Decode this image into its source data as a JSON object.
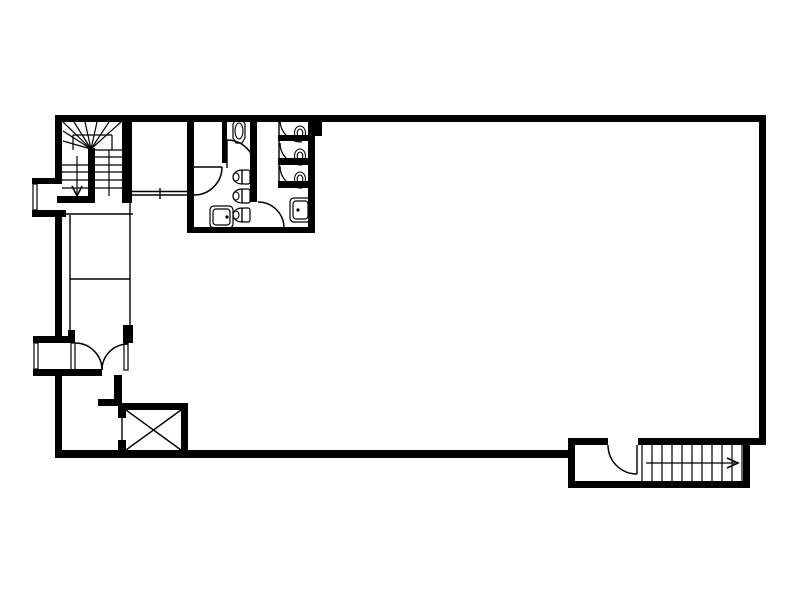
{
  "meta": {
    "description": "architectural-floor-plan",
    "background_color": "#ffffff",
    "line_color": "#000000"
  },
  "canvas": {
    "width": 800,
    "height": 600
  },
  "floorplan": {
    "layers": [
      {
        "name": "wall-segments",
        "item_name": "wall-segment",
        "type": "wall",
        "items": [
          [
            55,
            115,
            711,
            7
          ],
          [
            55,
            115,
            7,
            65
          ],
          [
            55,
            216,
            7,
            121
          ],
          [
            55,
            375,
            7,
            83
          ],
          [
            759,
            115,
            7,
            330
          ],
          [
            55,
            450,
            513,
            8
          ],
          [
            32,
            178,
            30,
            6
          ],
          [
            32,
            210,
            34,
            7
          ],
          [
            33,
            336,
            42,
            7
          ],
          [
            68,
            330,
            7,
            7
          ],
          [
            33,
            369,
            69,
            7
          ],
          [
            122,
            115,
            10,
            88
          ],
          [
            57,
            196,
            38,
            7
          ],
          [
            88,
            148,
            7,
            55
          ],
          [
            123,
            325,
            10,
            18
          ],
          [
            114,
            375,
            8,
            26
          ],
          [
            98,
            399,
            24,
            7
          ],
          [
            118,
            403,
            70,
            7
          ],
          [
            181,
            403,
            7,
            47
          ],
          [
            118,
            403,
            8,
            15
          ],
          [
            118,
            440,
            8,
            12
          ],
          [
            187,
            115,
            7,
            118
          ],
          [
            250,
            115,
            7,
            87
          ],
          [
            308,
            115,
            7,
            118
          ],
          [
            315,
            115,
            7,
            21
          ],
          [
            187,
            227,
            128,
            6
          ],
          [
            222,
            115,
            5,
            48
          ],
          [
            278,
            135,
            37,
            6
          ],
          [
            278,
            158,
            37,
            7
          ],
          [
            278,
            181,
            37,
            7
          ],
          [
            568,
            438,
            40,
            7
          ],
          [
            638,
            438,
            128,
            7
          ],
          [
            568,
            438,
            7,
            50
          ],
          [
            568,
            481,
            182,
            7
          ],
          [
            743,
            438,
            7,
            50
          ]
        ],
        "sw": 0
      },
      {
        "name": "partition-thin-lines",
        "item_name": "thin-wall-line",
        "type": "line",
        "items": [
          [
            62,
            214,
            133,
            214
          ],
          [
            70,
            215,
            70,
            336
          ],
          [
            130,
            203,
            130,
            325
          ],
          [
            70,
            279,
            130,
            279
          ],
          [
            132,
            191.5,
            191,
            191.5
          ],
          [
            132,
            195,
            191,
            195
          ],
          [
            160,
            188,
            160,
            199
          ],
          [
            194,
            167,
            222,
            167
          ],
          [
            227,
            140,
            227,
            168
          ],
          [
            279,
            122,
            279,
            188
          ],
          [
            637,
            445,
            637,
            474
          ]
        ],
        "sw": 1.4
      },
      {
        "name": "upper-stair-treads",
        "item_name": "stair-tread-line",
        "type": "line",
        "items": [
          [
            62,
            165,
            88,
            165
          ],
          [
            62,
            172,
            88,
            172
          ],
          [
            62,
            180,
            88,
            180
          ],
          [
            62,
            188,
            88,
            188
          ],
          [
            95,
            150,
            122,
            150
          ],
          [
            95,
            157,
            122,
            157
          ],
          [
            95,
            165,
            122,
            165
          ],
          [
            95,
            172,
            122,
            172
          ],
          [
            95,
            180,
            122,
            180
          ],
          [
            95,
            188,
            122,
            188
          ],
          [
            109,
            150,
            109,
            196
          ],
          [
            91,
            149,
            63,
            122
          ],
          [
            91,
            149,
            74,
            122
          ],
          [
            91,
            149,
            85,
            122
          ],
          [
            91,
            149,
            97,
            122
          ],
          [
            91,
            149,
            109,
            122
          ],
          [
            91,
            149,
            121,
            122
          ],
          [
            91,
            149,
            63,
            131
          ],
          [
            91,
            149,
            63,
            141
          ],
          [
            73,
            135,
            112,
            135
          ],
          [
            73,
            135,
            73,
            150
          ],
          [
            112,
            135,
            112,
            150
          ],
          [
            77,
            156,
            77,
            194
          ]
        ],
        "sw": 1.2
      },
      {
        "name": "lower-stair-treads",
        "item_name": "stair-tread-line",
        "type": "line",
        "items": [
          [
            642,
            445,
            642,
            481
          ],
          [
            652,
            445,
            652,
            481
          ],
          [
            662,
            445,
            662,
            481
          ],
          [
            672,
            445,
            672,
            481
          ],
          [
            682,
            445,
            682,
            481
          ],
          [
            692,
            445,
            692,
            481
          ],
          [
            702,
            445,
            702,
            481
          ],
          [
            712,
            445,
            712,
            481
          ],
          [
            722,
            445,
            722,
            481
          ],
          [
            732,
            445,
            732,
            481
          ],
          [
            742,
            445,
            742,
            481
          ],
          [
            646,
            463,
            735,
            463
          ]
        ],
        "sw": 1.2
      },
      {
        "name": "stair-direction-arrowheads",
        "item_name": "arrowhead",
        "type": "polyline",
        "items": [
          [
            72,
            186,
            77,
            196,
            82,
            186
          ],
          [
            727,
            458,
            738,
            463,
            727,
            468
          ]
        ],
        "sw": 1.6
      },
      {
        "name": "door-swing-arcs",
        "item_name": "door-arc",
        "type": "path",
        "items": [
          "M227,140 A28,28 0 0 1 255,168",
          "M222,167 A28,28 0 0 1 194,195",
          "M258,202 A26,26 0 0 1 284,228",
          "M75,343 A27,27 0 0 1 102,370",
          "M128,344 A26,26 0 0 0 102,370",
          "M608,445 A29,29 0 0 0 637,474"
        ],
        "sw": 1.5
      },
      {
        "name": "door-leaves",
        "item_name": "door-leaf",
        "type": "rect-outline",
        "items": [
          [
            71,
            343,
            4,
            27,
            0
          ],
          [
            124,
            343,
            4,
            27,
            0
          ]
        ],
        "sw": 1.2
      },
      {
        "name": "window-glazing",
        "item_name": "window-pane",
        "type": "rect-outline",
        "items": [
          [
            33,
            184,
            4,
            26,
            0
          ],
          [
            34,
            343,
            4,
            26,
            0
          ]
        ],
        "sw": 1.2
      },
      {
        "name": "elevator-shaft-x",
        "item_name": "shaft-line",
        "type": "line",
        "items": [
          [
            126,
            410,
            181,
            450
          ],
          [
            181,
            410,
            126,
            450
          ],
          [
            122,
            418,
            122,
            440
          ]
        ],
        "sw": 1.4
      },
      {
        "name": "toilet-stall-arcs",
        "item_name": "stall-door-arc",
        "type": "path",
        "items": [
          "M280,120 A22,22 0 0 0 302,142",
          "M280,143 A22,22 0 0 0 302,165",
          "M280,166 A22,22 0 0 0 302,188"
        ],
        "sw": 1.2
      },
      {
        "name": "toilet-bowls",
        "item_name": "toilet-bowl",
        "type": "path",
        "items": [
          "M242,170 A9,7 0 0 0 242,184 Z",
          "M242,189 A9,7 0 0 0 242,203 Z",
          "M242,208 A9,7 0 0 0 242,222 Z"
        ],
        "sw": 1.2
      },
      {
        "name": "toilet-tanks",
        "item_name": "toilet-tank",
        "type": "rect-outline",
        "items": [
          [
            242,
            170,
            8,
            14,
            2
          ],
          [
            242,
            189,
            8,
            14,
            2
          ],
          [
            242,
            208,
            8,
            14,
            2
          ]
        ],
        "sw": 1.2
      },
      {
        "name": "urinal-fixture",
        "item_name": "urinal-outline",
        "type": "polygon",
        "items": [
          [
            233,
            124,
            236,
            119,
            242,
            119,
            245,
            124,
            245,
            138,
            242,
            143,
            236,
            143,
            233,
            138
          ]
        ],
        "sw": 1.2
      },
      {
        "name": "fixture-ellipses",
        "item_name": "fixture-ellipse",
        "type": "ellipse",
        "items": [
          [
            239,
            131,
            4,
            8
          ],
          [
            236,
            177,
            3,
            4
          ],
          [
            236,
            196,
            3,
            4
          ],
          [
            236,
            215,
            3,
            4
          ],
          [
            300,
            133,
            5.5,
            7
          ],
          [
            300,
            156,
            5.5,
            7
          ],
          [
            300,
            179,
            5.5,
            7
          ],
          [
            300,
            133,
            2.8,
            4
          ],
          [
            300,
            156,
            2.8,
            4
          ],
          [
            300,
            179,
            2.8,
            4
          ]
        ],
        "sw": 1.1
      },
      {
        "name": "sink-basins",
        "item_name": "sink-outline",
        "type": "rect-outline",
        "items": [
          [
            210,
            206,
            23,
            22,
            4
          ],
          [
            213,
            209,
            17,
            16,
            3
          ],
          [
            290,
            198,
            21,
            24,
            4
          ],
          [
            293,
            201,
            15,
            18,
            3
          ]
        ],
        "sw": 1.2
      },
      {
        "name": "sink-drains",
        "item_name": "sink-drain-dot",
        "type": "dot",
        "items": [
          [
            227,
            217,
            1.6
          ],
          [
            298,
            210,
            1.6
          ]
        ],
        "sw": 0
      }
    ]
  }
}
